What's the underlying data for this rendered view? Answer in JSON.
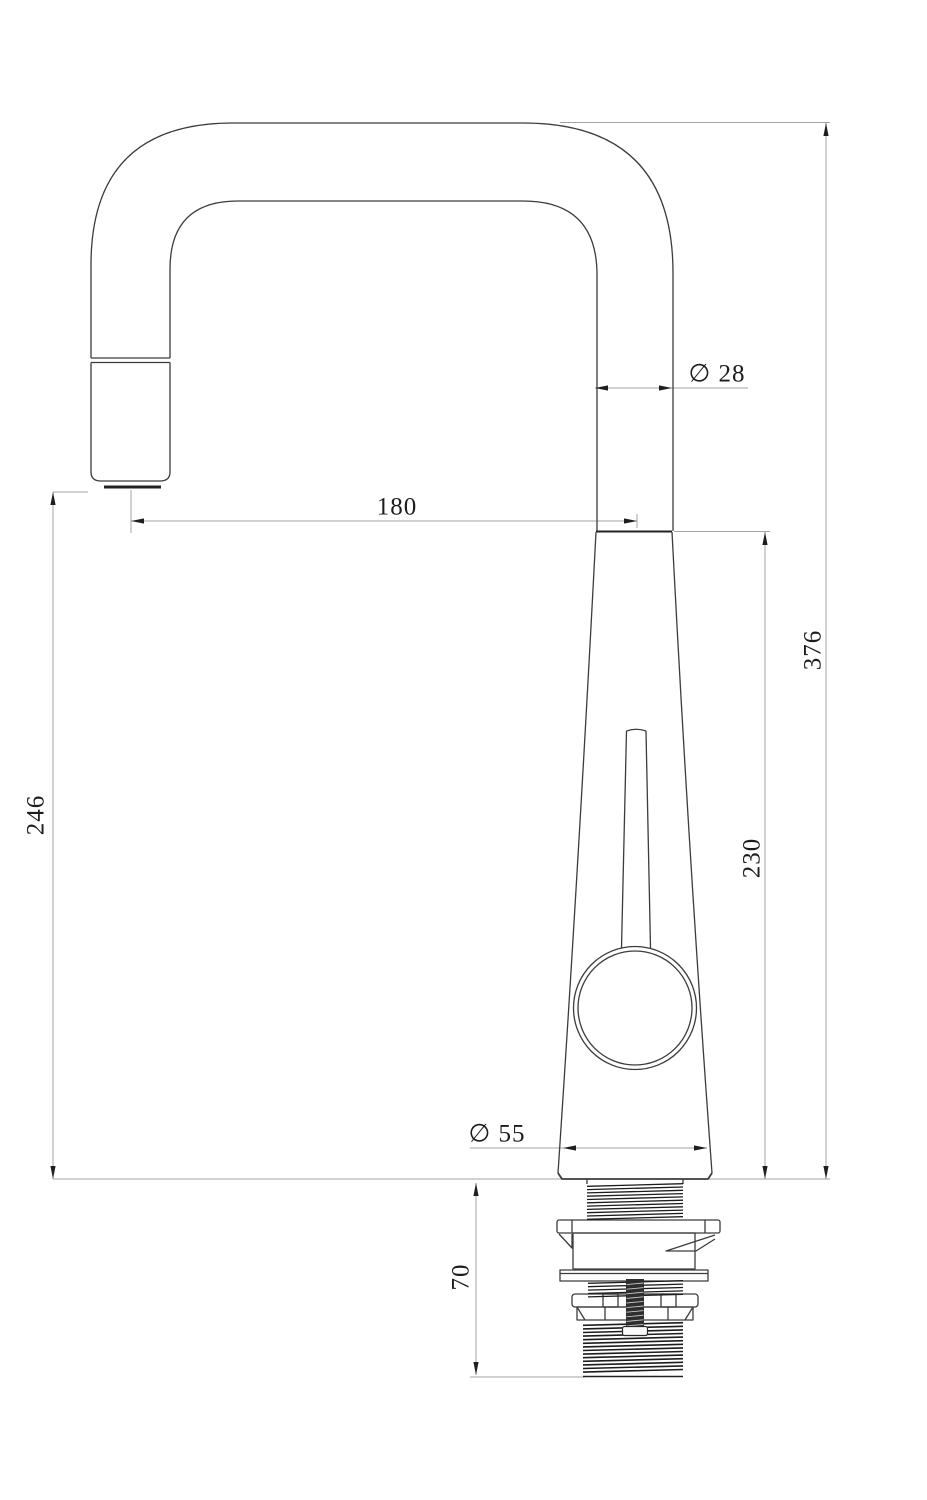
{
  "drawing": {
    "type": "technical-dimension-drawing",
    "subject": "pull-out kitchen faucet, side elevation",
    "background_color": "#ffffff",
    "object_line_color": "#3c3c3c",
    "thread_line_color": "#1c1c1c",
    "dimension_line_color": "#a3a3a3",
    "arrow_color": "#1f1f1f",
    "text_color": "#1c1c1c"
  },
  "dimensions": {
    "outlet_height": "246",
    "spout_reach": "180",
    "spout_diameter": "∅ 28",
    "total_height": "376",
    "body_height": "230",
    "base_diameter": "∅ 55",
    "shank_length": "70"
  }
}
